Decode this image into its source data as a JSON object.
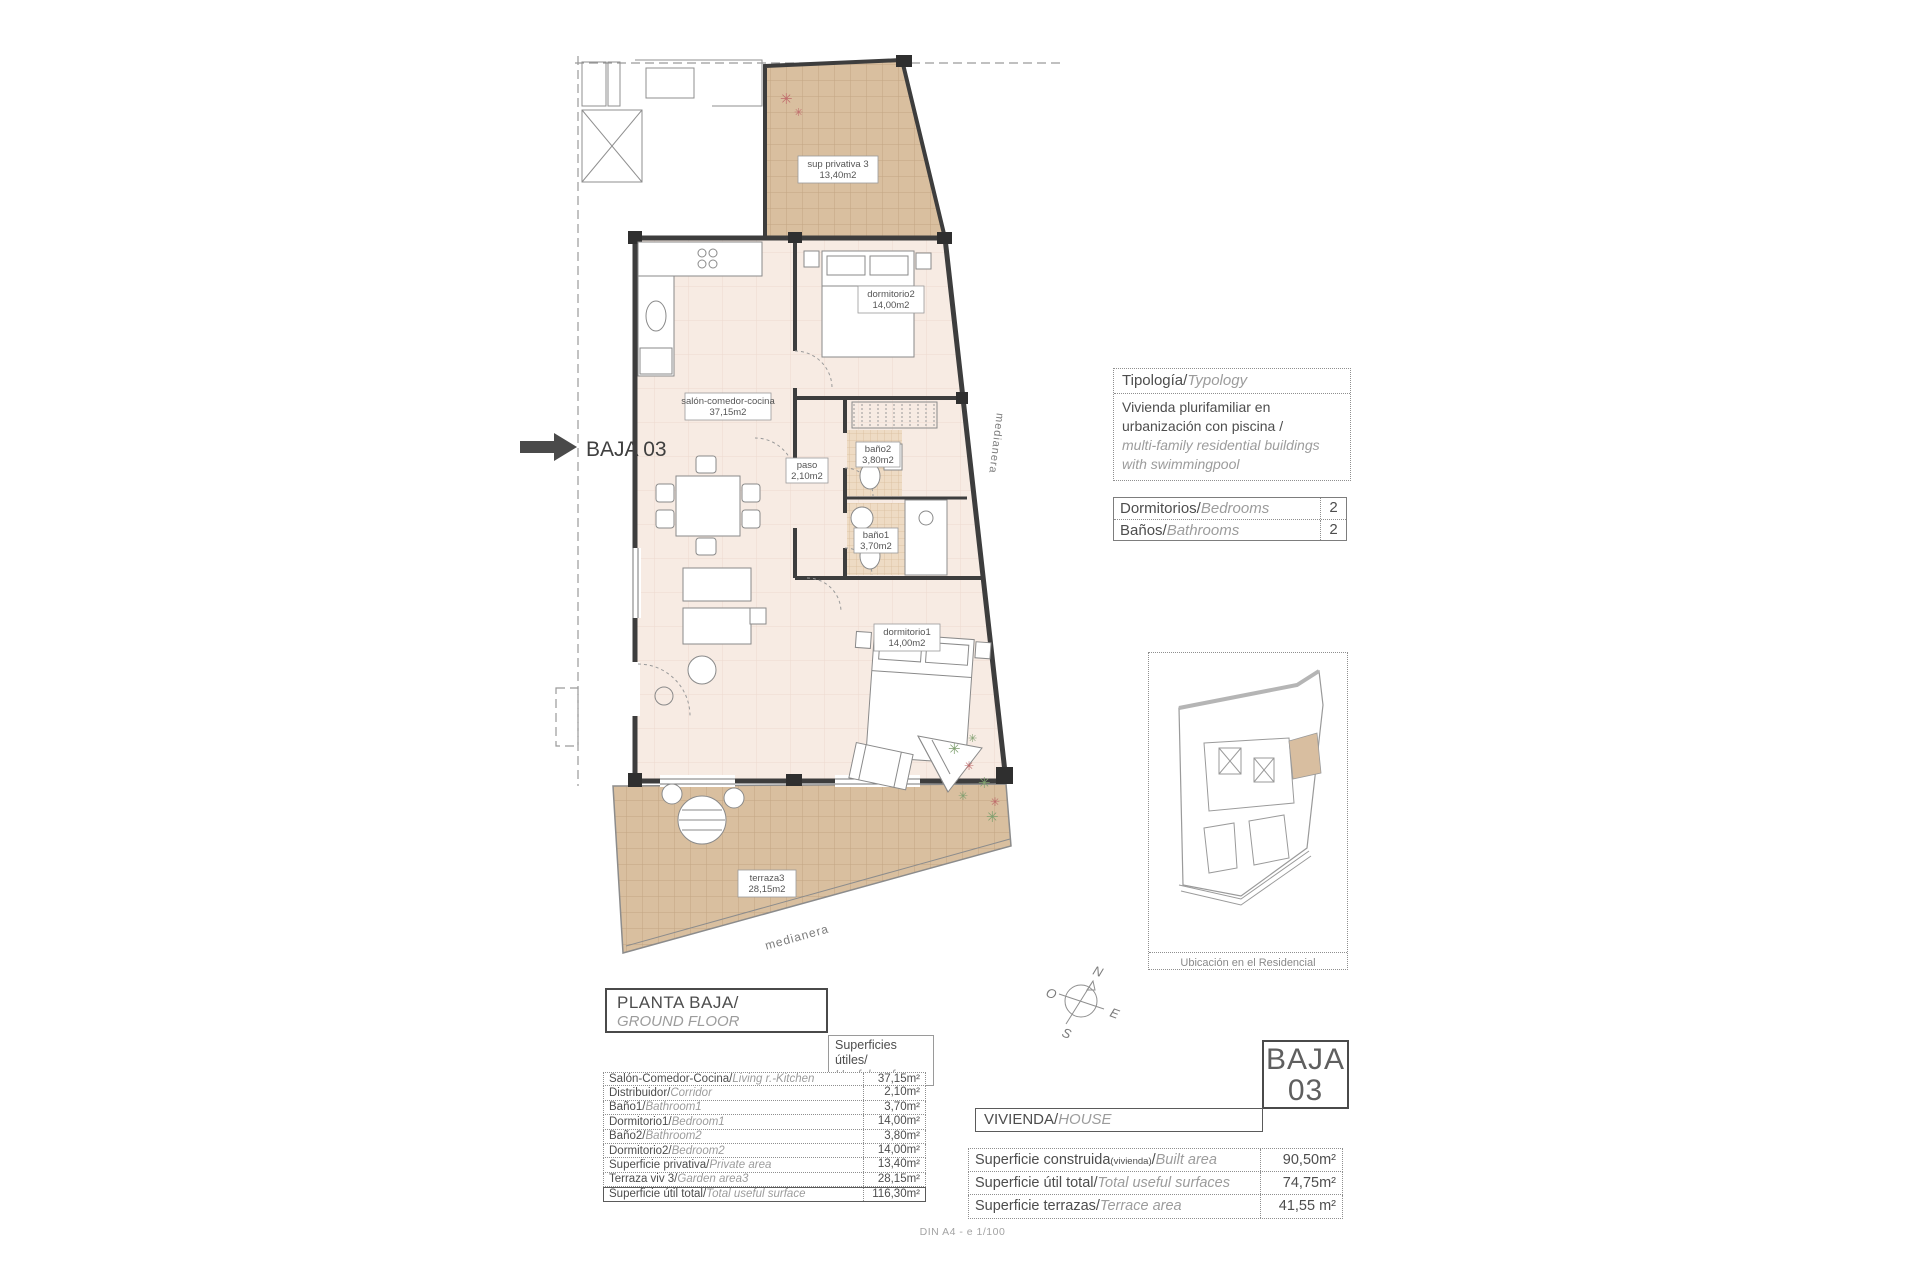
{
  "plan": {
    "marker": "BAJA 03",
    "medianera_right": "medianera",
    "medianera_bottom": "medianera",
    "rooms": {
      "sup_privativa": {
        "name": "sup privativa 3",
        "area": "13,40m2"
      },
      "dormitorio2": {
        "name": "dormitorio2",
        "area": "14,00m2"
      },
      "salon": {
        "name": "salón-comedor-cocina",
        "area": "37,15m2"
      },
      "bano2": {
        "name": "baño2",
        "area": "3,80m2"
      },
      "paso": {
        "name": "paso",
        "area": "2,10m2"
      },
      "bano1": {
        "name": "baño1",
        "area": "3,70m2"
      },
      "dormitorio1": {
        "name": "dormitorio1",
        "area": "14,00m2"
      },
      "terraza": {
        "name": "terraza3",
        "area": "28,15m2"
      }
    }
  },
  "typology": {
    "title_es": "Tipología/",
    "title_en": "Typology",
    "body_es_1": "Vivienda plurifamiliar en",
    "body_es_2": "urbanización con piscina  /",
    "body_en_1": "multi-family residential buildings",
    "body_en_2": "with swimmingpool"
  },
  "counts": {
    "rows": [
      {
        "es": "Dormitorios/",
        "en": "Bedrooms",
        "value": "2"
      },
      {
        "es": "Baños/",
        "en": "Bathrooms",
        "value": "2"
      }
    ]
  },
  "minimap": {
    "caption": "Ubicación en el Residencial"
  },
  "floor_box": {
    "es": "PLANTA BAJA/",
    "en": "GROUND FLOOR"
  },
  "useful_label": {
    "es": "Superficies útiles/",
    "en": "Useful surfaces"
  },
  "surfaces": {
    "rows": [
      {
        "es": "Salón-Comedor-Cocina/",
        "en": "Living r.-Kitchen",
        "value": "37,15m²"
      },
      {
        "es": "Distribuidor/",
        "en": "Corridor",
        "value": "2,10m²"
      },
      {
        "es": "Baño1/",
        "en": "Bathroom1",
        "value": "3,70m²"
      },
      {
        "es": "Dormitorio1/",
        "en": "Bedroom1",
        "value": "14,00m²"
      },
      {
        "es": "Baño2/",
        "en": "Bathroom2",
        "value": "3,80m²"
      },
      {
        "es": "Dormitorio2/",
        "en": "Bedroom2",
        "value": "14,00m²"
      },
      {
        "es": "Superficie privativa/",
        "en": "Private area",
        "value": "13,40m²"
      },
      {
        "es": "Terraza viv 3/",
        "en": "Garden area3",
        "value": "28,15m²"
      },
      {
        "es": "Superficie útil total/",
        "en": "Total useful surface",
        "value": "116,30m²"
      }
    ]
  },
  "unit_box": {
    "line1": "BAJA",
    "line2": "03"
  },
  "vivienda_bar": {
    "es": "VIVIENDA/",
    "en": "HOUSE"
  },
  "summary": {
    "rows": [
      {
        "es": "Superficie construida",
        "small": "(vivienda)",
        "sep": "/",
        "en": "Built area",
        "value": "90,50m²"
      },
      {
        "es": "Superficie útil total",
        "small": "",
        "sep": "/",
        "en": "Total useful surfaces",
        "value": "74,75m²"
      },
      {
        "es": "Superficie terrazas",
        "small": "",
        "sep": "/",
        "en": "Terrace area",
        "value": "41,55 m²"
      }
    ]
  },
  "compass": {
    "n": "N",
    "s": "S",
    "e": "E",
    "o": "O"
  },
  "footer": {
    "text": "DIN A4 - e 1/100"
  }
}
